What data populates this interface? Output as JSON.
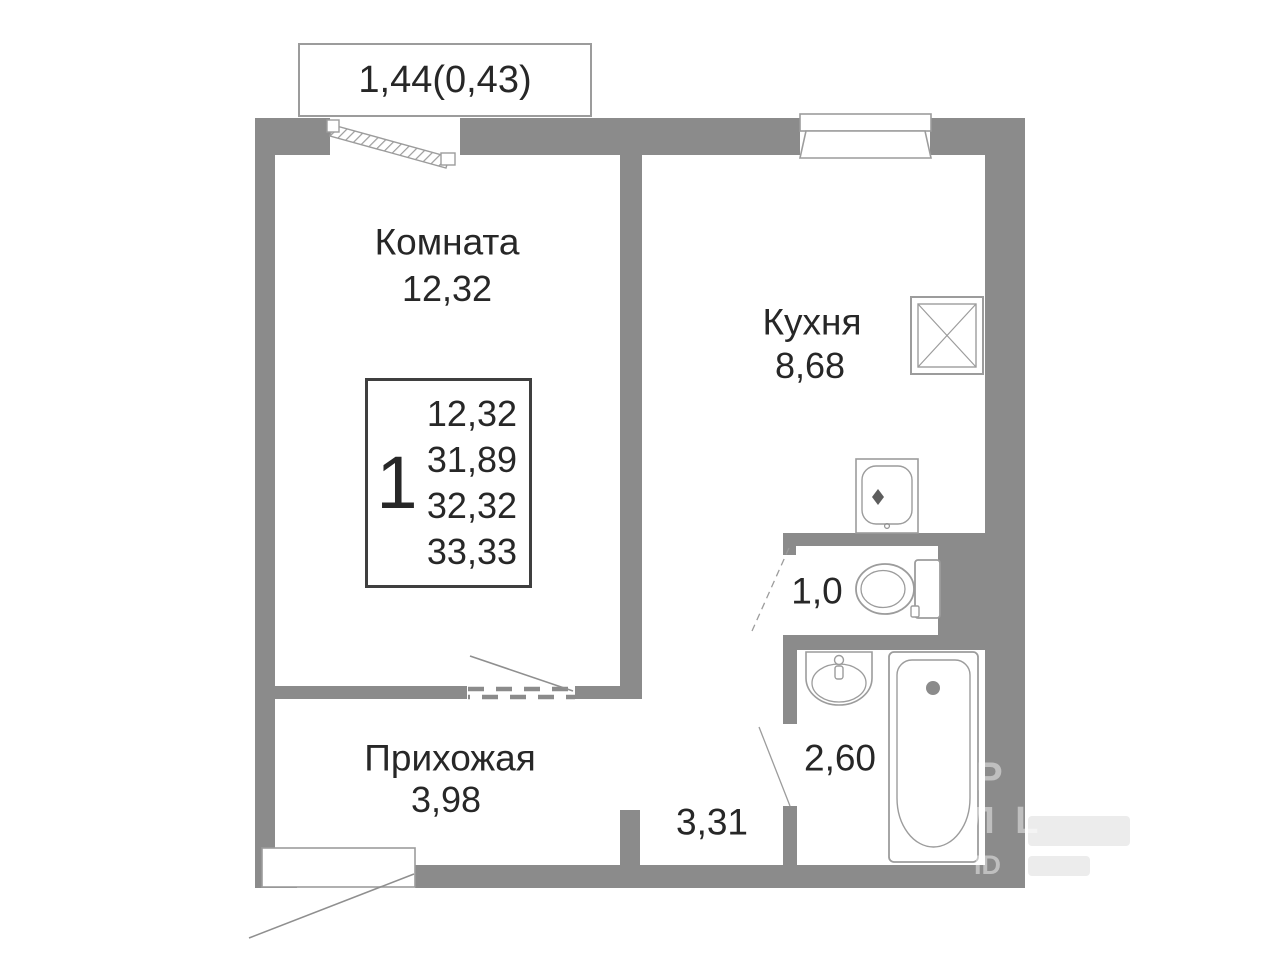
{
  "colors": {
    "wall": "#8b8b8b",
    "line": "#9c9c9c",
    "text": "#272727",
    "wm": "rgba(255,255,255,0.45)",
    "wm2": "#ececec"
  },
  "plan": {
    "balcony_dimension": "1,44(0,43)",
    "rooms": [
      {
        "id": "living",
        "name": "Комната",
        "area": "12,32"
      },
      {
        "id": "kitchen",
        "name": "Кухня",
        "area": "8,68"
      },
      {
        "id": "hallway",
        "name": "Прихожая",
        "area": "3,98"
      },
      {
        "id": "wc",
        "name": "",
        "area": "1,0"
      },
      {
        "id": "bathroom",
        "name": "",
        "area": "2,60"
      },
      {
        "id": "corridor",
        "name": "",
        "area": "3,31"
      }
    ]
  },
  "legend": {
    "rooms_count": "1",
    "values": [
      "12,32",
      "31,89",
      "32,32",
      "33,33"
    ]
  },
  "watermark": {
    "line1": "Р",
    "line2": "Л L",
    "line3": "ID"
  },
  "icons": [
    "balcony-window-icon",
    "kitchen-window-icon",
    "vent-shaft-icon",
    "kitchen-sink-icon",
    "toilet-icon",
    "bathroom-sink-icon",
    "bathtub-icon",
    "door-swing-living-icon",
    "door-swing-wc-icon",
    "door-swing-bathroom-icon",
    "door-swing-entrance-icon"
  ]
}
